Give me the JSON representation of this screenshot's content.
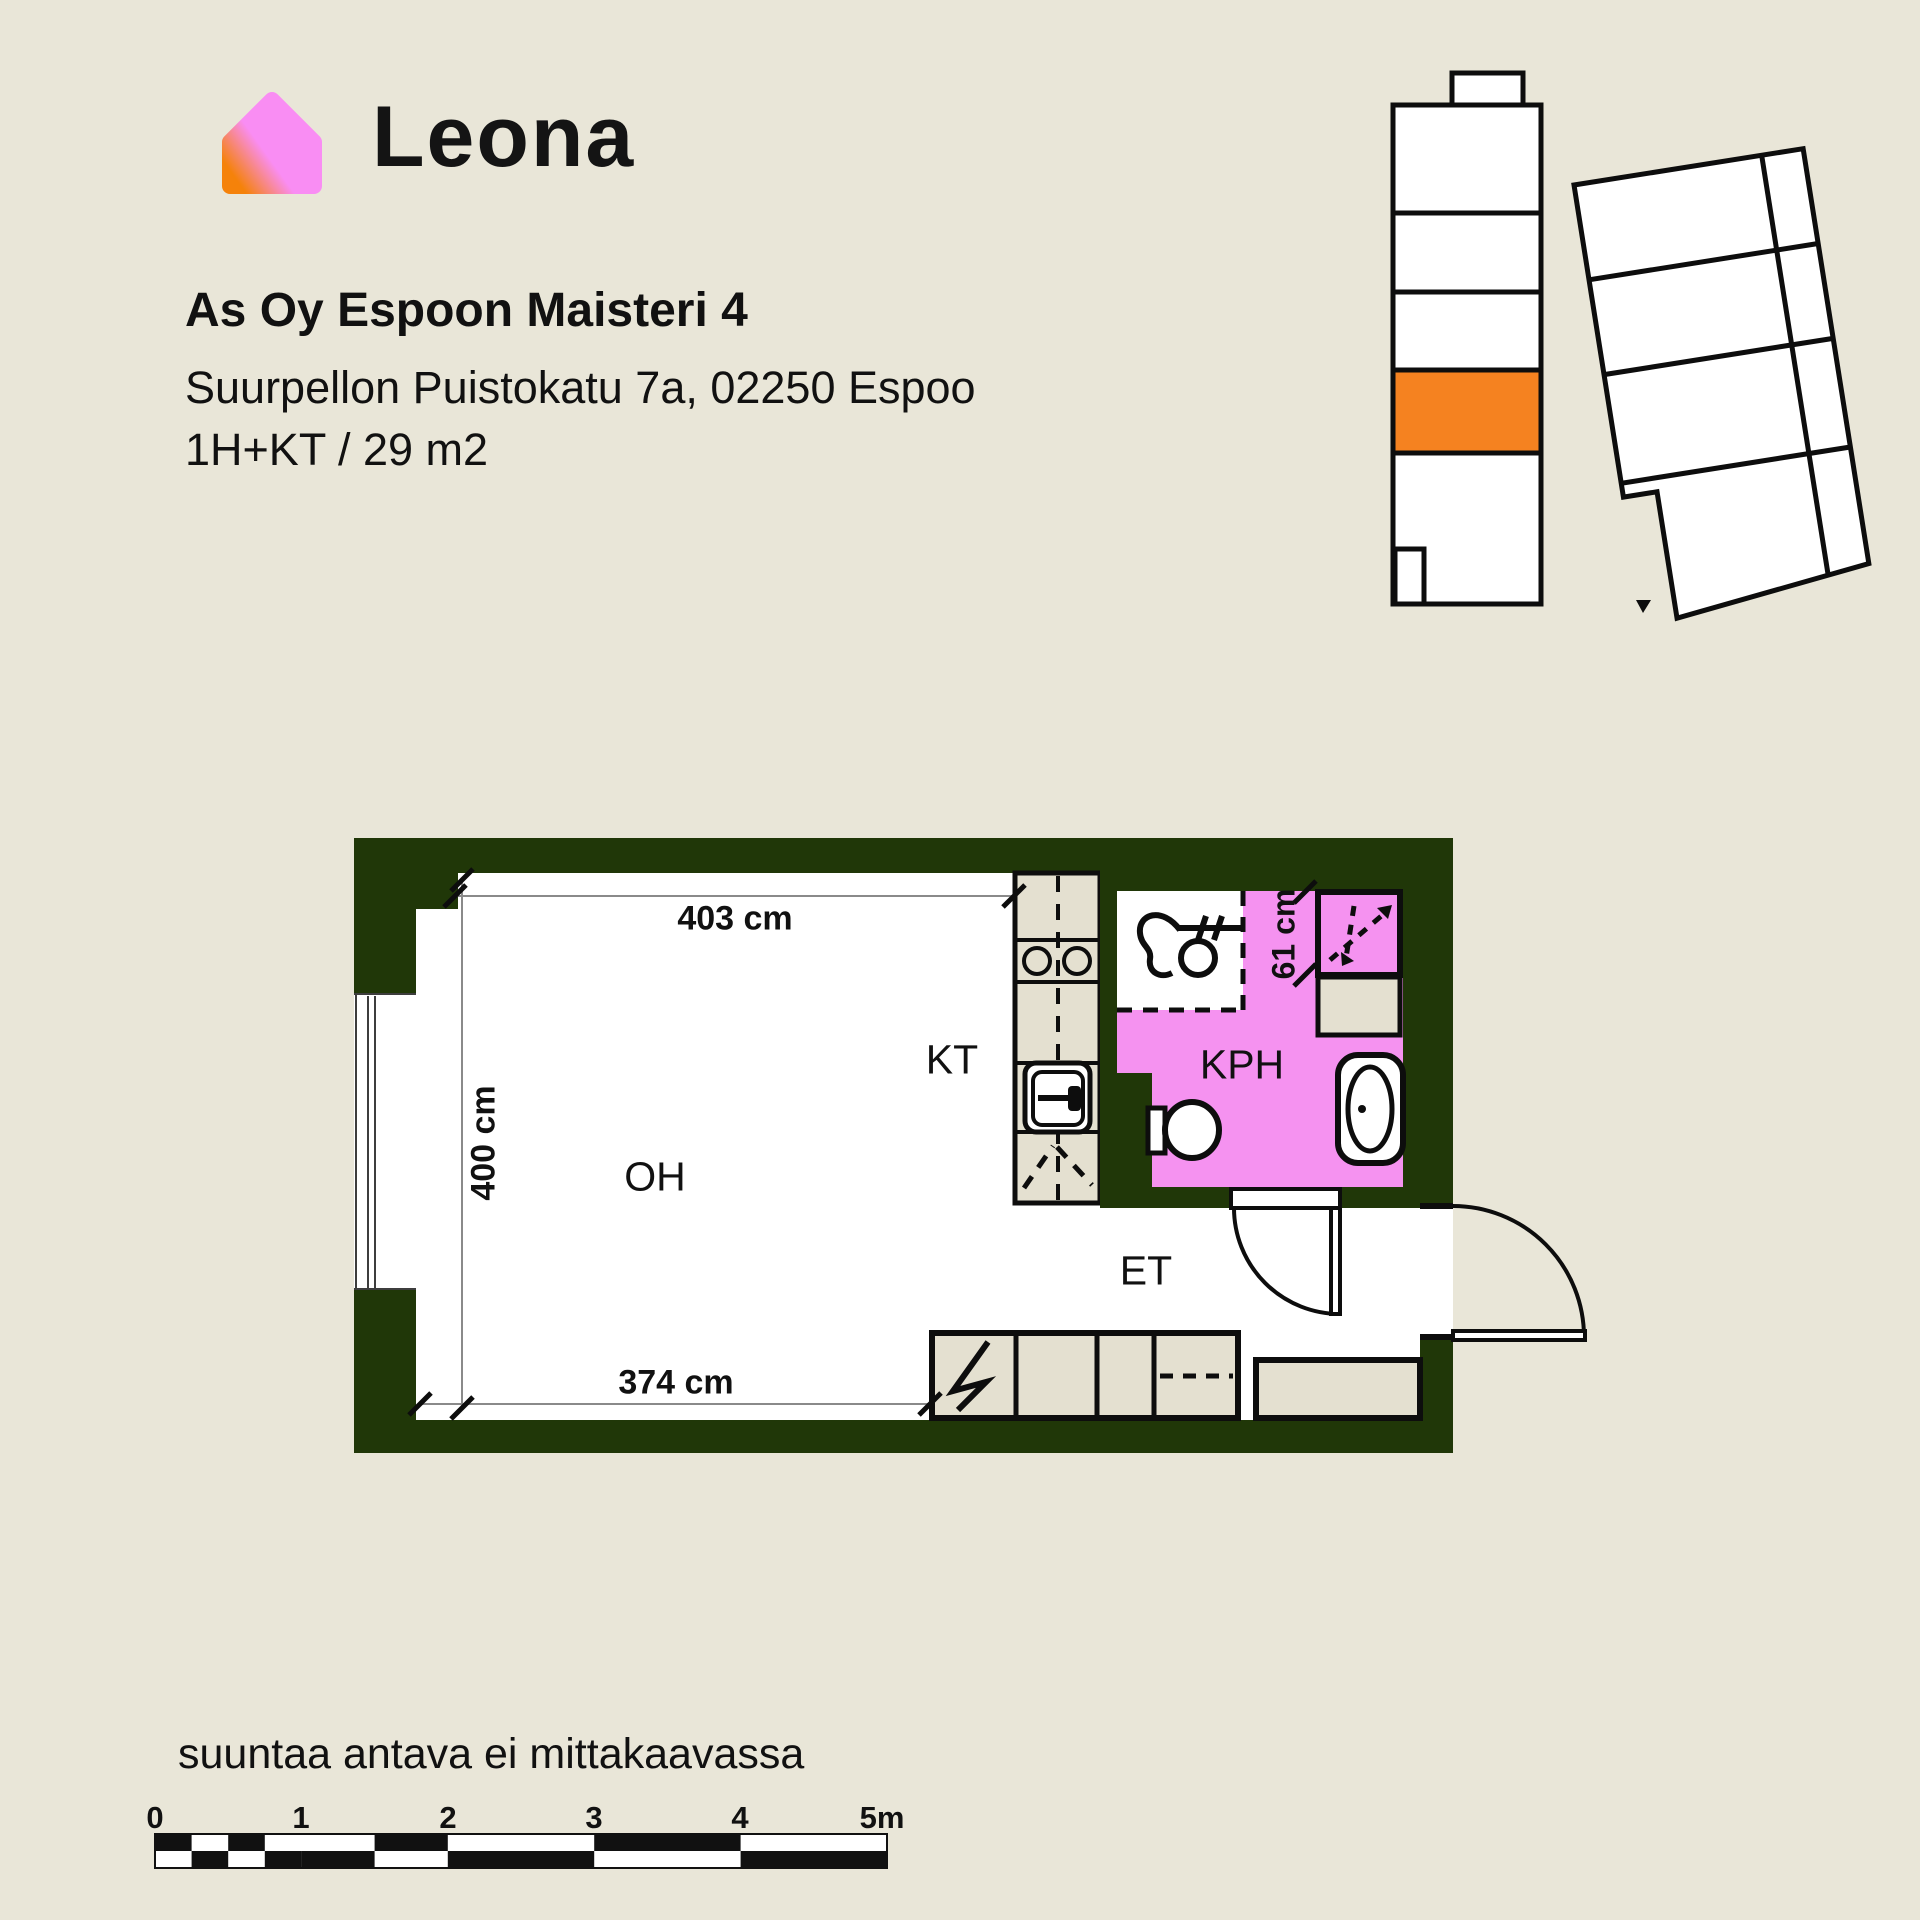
{
  "brand": {
    "name": "Leona"
  },
  "header": {
    "title": "As Oy Espoon Maisteri 4",
    "address": "Suurpellon Puistokatu 7a, 02250 Espoo",
    "apartment_type": "1H+KT / 29 m2"
  },
  "floor_plan": {
    "room_labels": {
      "living_room": "OH",
      "kitchenette": "KT",
      "bathroom": "KPH",
      "hallway": "ET"
    },
    "dimensions": {
      "top_width": "403 cm",
      "left_height": "400 cm",
      "bottom_width": "374 cm",
      "shower_width": "61 cm"
    }
  },
  "site_plan": {
    "highlighted_unit_color": "#F58220"
  },
  "footer": {
    "note": "suuntaa antava ei mittakaavassa",
    "scale_labels": [
      "0",
      "1",
      "2",
      "3",
      "4",
      "5m"
    ]
  },
  "colors": {
    "background": "#E9E6D8",
    "wall_green": "#203708",
    "bathroom_pink": "#F592F0",
    "cabinet_beige": "#E4E0D0",
    "highlight_orange": "#F58220",
    "logo_pink": "#F98DF3",
    "logo_orange": "#F5820A",
    "line_black": "#0D0D0D"
  }
}
